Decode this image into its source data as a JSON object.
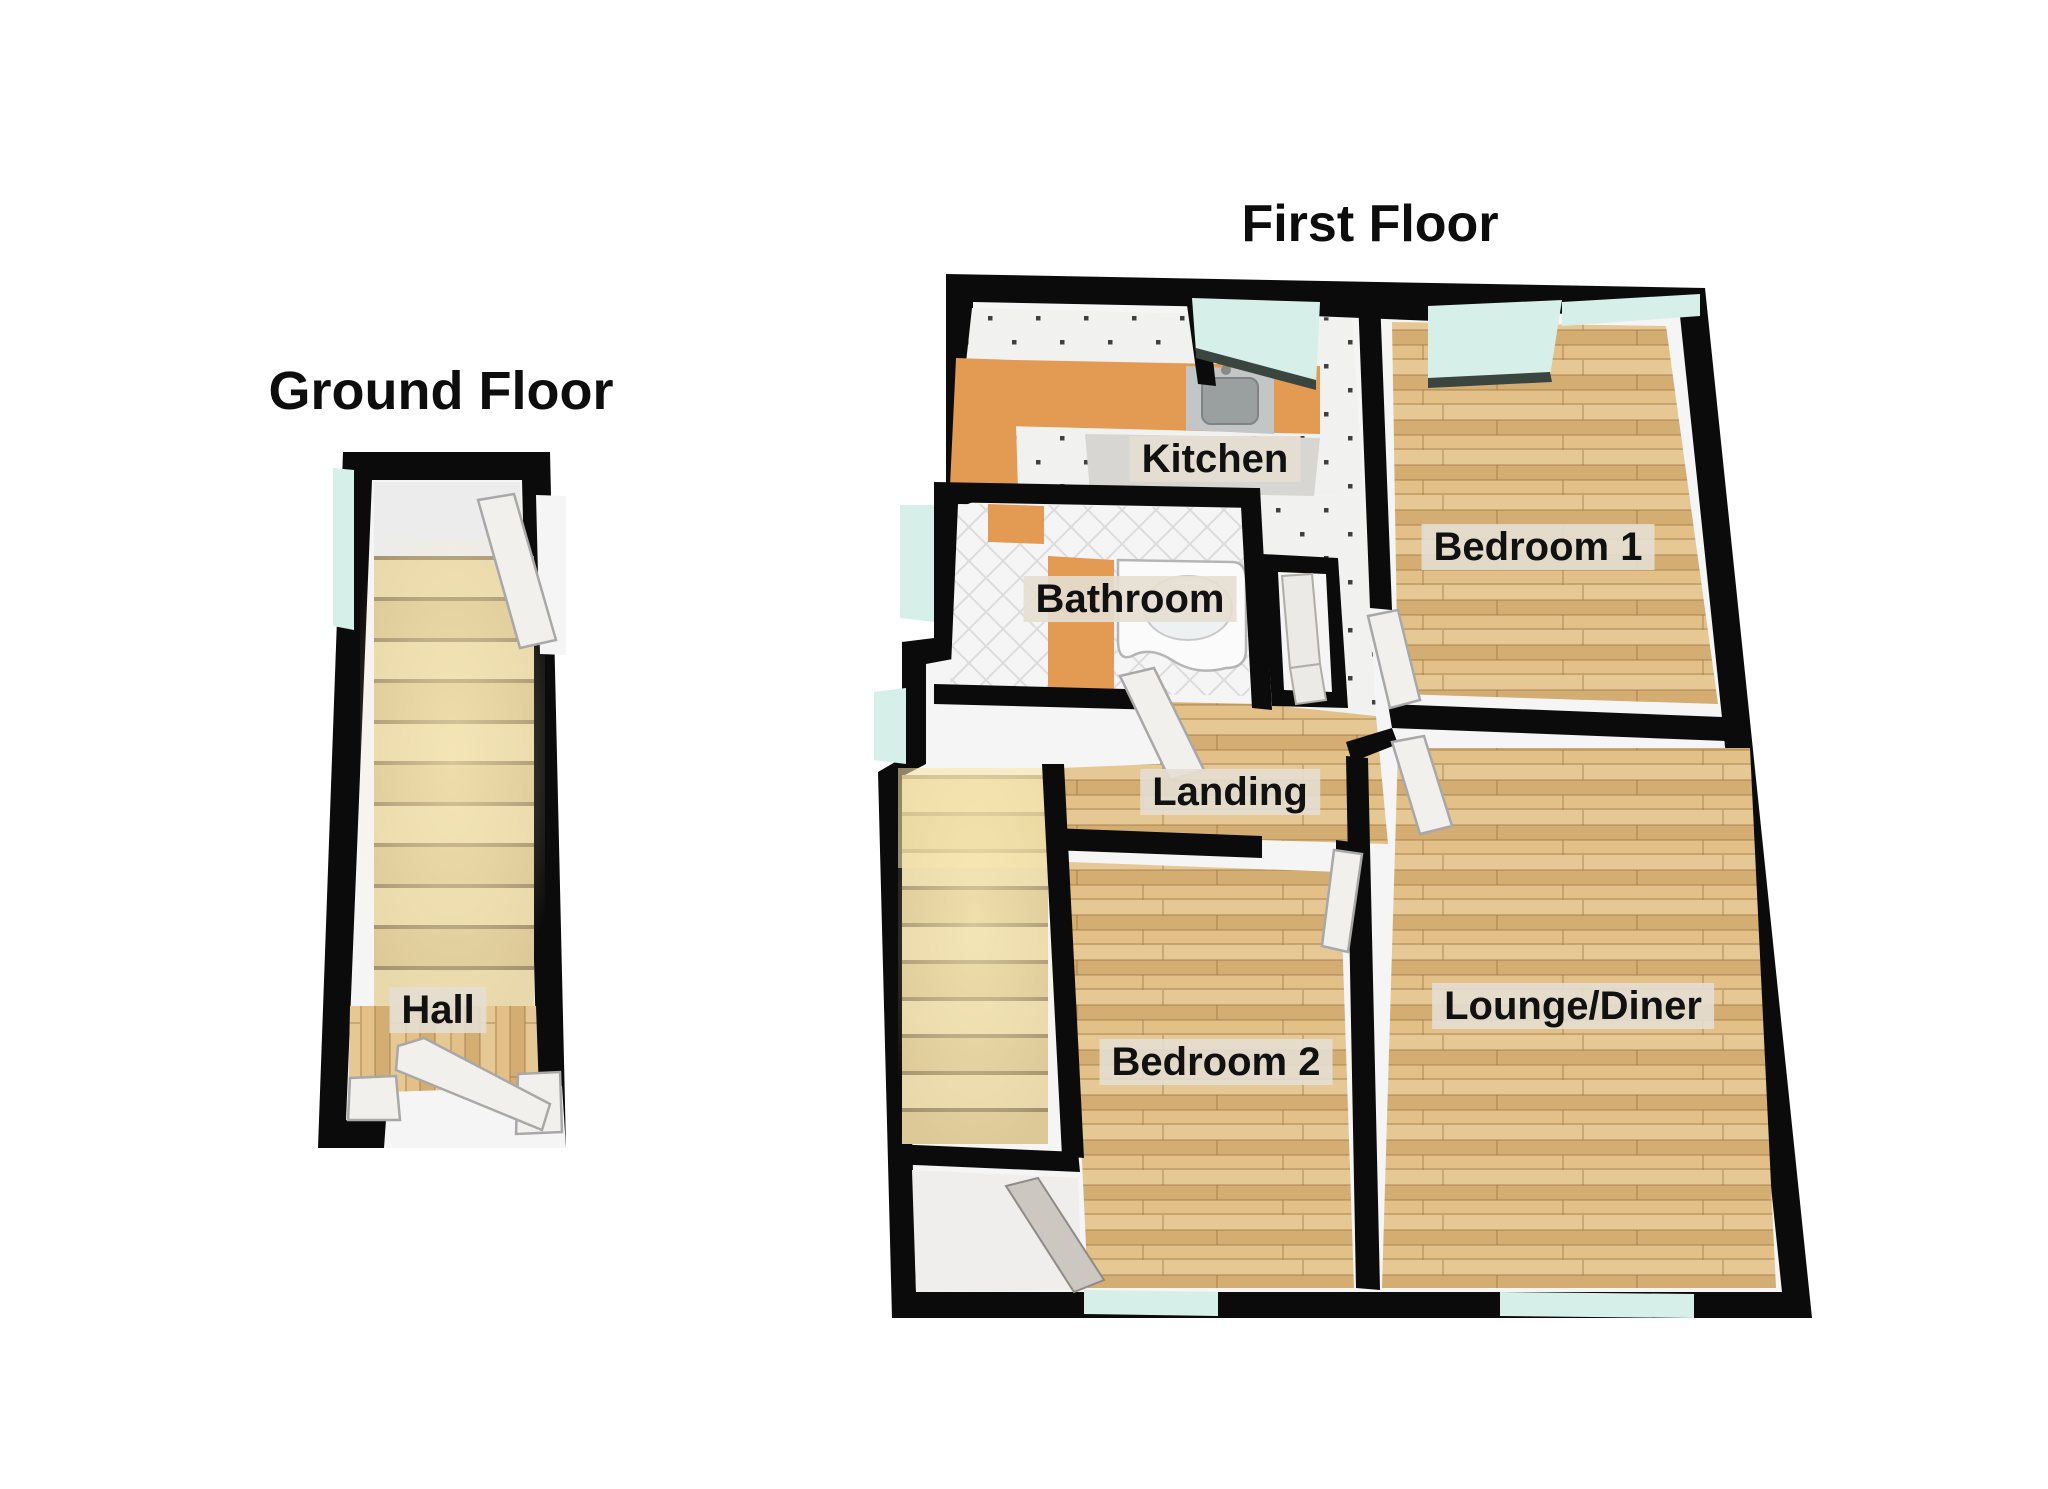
{
  "titles": {
    "ground": "Ground Floor",
    "first": "First Floor"
  },
  "rooms": {
    "hall": "Hall",
    "kitchen": "Kitchen",
    "bathroom": "Bathroom",
    "landing": "Landing",
    "bedroom1": "Bedroom 1",
    "bedroom2": "Bedroom 2",
    "lounge": "Lounge/Diner"
  },
  "colors": {
    "wall": "#0b0b0b",
    "innerWall": "#f5f5f5",
    "woodBase": "#debb84",
    "tile": "#f1f1f0",
    "tileDot": "#3f3f3f",
    "bathTileLine": "#dcdcdc",
    "counter": "#e39a52",
    "unit": "#d8d6d2",
    "sinkOuter": "#c2c6c6",
    "sinkBasin": "#9aa0a0",
    "glass": "#d6efe9",
    "glassRim": "#3a453f",
    "stairLight": "#e8d8ab",
    "stairDark": "#dcc997",
    "stairEdge": "#a5936f",
    "doorLeaf": "#f2f0ed",
    "doorStroke": "#a8a8a8",
    "porchDoor": "#cdc7c2",
    "labelBg": "rgba(228,222,210,0.9)",
    "labelText": "#111111"
  }
}
